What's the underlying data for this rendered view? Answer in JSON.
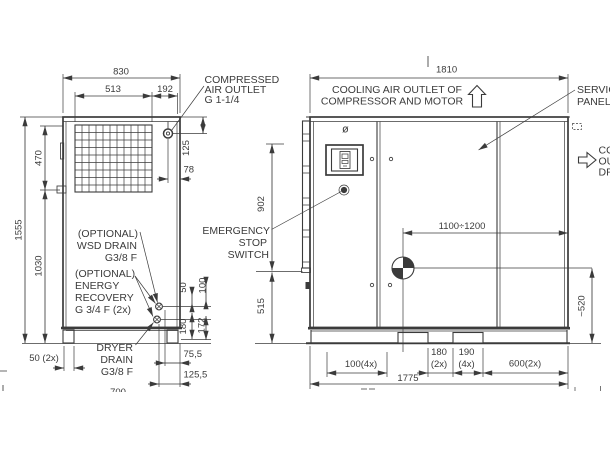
{
  "colors": {
    "ink": "#3b3b3b",
    "paper": "#ffffff"
  },
  "side_view": {
    "dimensions": {
      "overall_width": "830",
      "grille_width": "513",
      "outlet_offset": "192",
      "grille_height": "470",
      "total_height": "1555",
      "body_height": "1030",
      "outlet_from_top": "125",
      "outlet_from_edge": "78",
      "foot_width": "50 (2x)",
      "port_spacing_a": "50",
      "port_spacing_b": "100",
      "port_height_a": "180",
      "port_height_b": "172",
      "drain_offset_a": "75,5",
      "drain_offset_b": "125,5",
      "clipped_bottom": "700"
    },
    "callouts": {
      "air_outlet": {
        "l1": "COMPRESSED",
        "l2": "AIR OUTLET",
        "l3": "G 1-1/4"
      },
      "wsd_drain": {
        "l1": "(OPTIONAL)",
        "l2": "WSD DRAIN",
        "l3": "G3/8 F"
      },
      "energy_recovery": {
        "l1": "(OPTIONAL)",
        "l2": "ENERGY",
        "l3": "RECOVERY",
        "l4": "G 3/4 F (2x)"
      },
      "dryer_drain": {
        "l1": "DRYER",
        "l2": "DRAIN",
        "l3": "G3/8 F"
      }
    }
  },
  "front_view": {
    "dimensions": {
      "overall_width": "1810",
      "cog_range": "1100÷1200",
      "upper_height": "902",
      "lower_height": "515",
      "cog_height": "~520",
      "foot_pitch": "100(4x)",
      "slot_gap": "180",
      "slot_gap_qty": "(2x)",
      "slot_width": "190",
      "slot_width_qty": "(4x)",
      "slot_pitch": "600(2x)",
      "base_width": "1775"
    },
    "callouts": {
      "cooling_top": {
        "l1": "COOLING AIR OUTLET OF",
        "l2": "COMPRESSOR AND MOTOR"
      },
      "service_panel": {
        "l1": "SERVICE",
        "l2": "PANEL"
      },
      "cooling_right": {
        "l1": "COOLING AIR",
        "l2": "OUTLET OF",
        "l3": "DRYER"
      },
      "emergency_stop": {
        "l1": "EMERGENCY",
        "l2": "STOP",
        "l3": "SWITCH"
      },
      "vent_symbol": "ø"
    }
  }
}
